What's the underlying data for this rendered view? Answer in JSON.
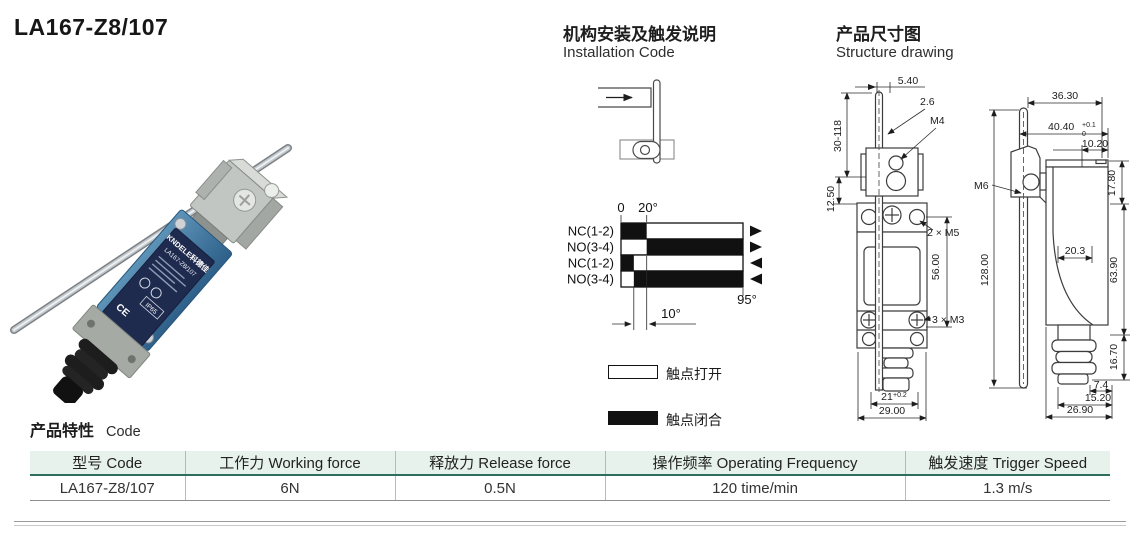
{
  "page": {
    "title": "LA167-Z8/107"
  },
  "colors": {
    "table_header_bg": "#e7f2ec",
    "table_header_rule": "#2e6e5e",
    "product_body_blue": "#3f75a2",
    "product_label_navy": "#1f2b4e"
  },
  "photo": {
    "brand": "KNDELE科德佳",
    "model": "LA167-Z8/107",
    "ip_rating": "IP65",
    "ce_mark": "CE"
  },
  "installation": {
    "heading_cn": "机构安装及触发说明",
    "heading_en": "Installation Code"
  },
  "structure": {
    "heading_cn": "产品尺寸图",
    "heading_en": "Structure drawing",
    "front": {
      "rod_offset": "5.40",
      "rod_dia": "2.6",
      "clamp_thread": "M4",
      "lever_range": "30-118",
      "pivot_height": "12.50",
      "mount_thread": "2 × M5",
      "hole_spacing": "56.00",
      "cover_thread": "3 × M3",
      "width_inner": "21",
      "width_inner_tol": "+0.2",
      "width": "29.00"
    },
    "side": {
      "head_width": "36.30",
      "overall_width": "40.40",
      "overall_width_tol_up": "+0.1",
      "overall_width_tol_dn": "0",
      "top_offset": "10.20",
      "plate_height": "17.80",
      "head_thread": "M6",
      "body_inner": "20.3",
      "lever_length": "128.00",
      "body_height": "63.90",
      "gland_height": "16.70",
      "gland_offset": "7.4",
      "gland_width": "15.20",
      "depth": "26.90"
    }
  },
  "chart_data": {
    "type": "bar",
    "title": "Contact state vs. lever rotation angle",
    "x_unit": "degrees",
    "x_range": [
      0,
      95
    ],
    "operate_angle": 20,
    "differential_angle": 10,
    "ticks": {
      "zero": "0",
      "operate": "20°",
      "max": "95°",
      "differential": "10°"
    },
    "rows": [
      {
        "label": "NC(1-2)",
        "direction": "forward",
        "closed": [
          [
            0,
            20
          ]
        ]
      },
      {
        "label": "NO(3-4)",
        "direction": "forward",
        "closed": [
          [
            20,
            95
          ]
        ]
      },
      {
        "label": "NC(1-2)",
        "direction": "return",
        "closed": [
          [
            0,
            10
          ]
        ]
      },
      {
        "label": "NO(3-4)",
        "direction": "return",
        "closed": [
          [
            10,
            95
          ]
        ]
      }
    ],
    "legend": {
      "open": "触点打开",
      "closed": "触点闭合"
    },
    "legend_position": "below"
  },
  "features": {
    "title_cn": "产品特性",
    "title_en": "Code",
    "headers": [
      "型号 Code",
      "工作力 Working force",
      "释放力 Release force",
      "操作频率 Operating Frequency",
      "触发速度 Trigger Speed"
    ],
    "row": [
      "LA167-Z8/107",
      "6N",
      "0.5N",
      "120 time/min",
      "1.3 m/s"
    ]
  }
}
